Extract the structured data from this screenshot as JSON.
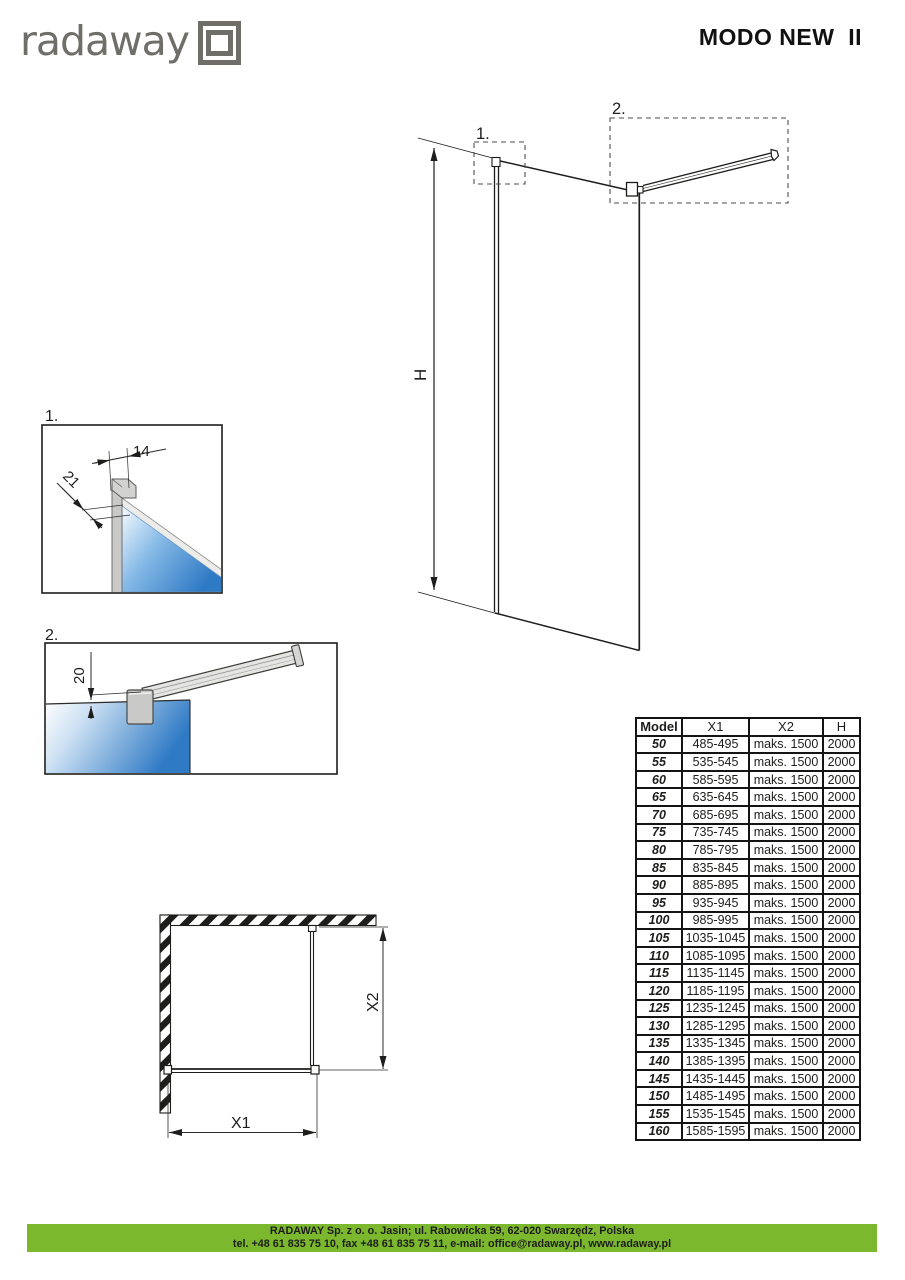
{
  "header": {
    "logo_text": "radaway",
    "title": "MODO NEW  II"
  },
  "drawing_labels": {
    "main_callout_1": "1.",
    "main_callout_2": "2.",
    "main_height": "H",
    "detail1_label": "1.",
    "detail1_width": "14",
    "detail1_depth": "21",
    "detail2_label": "2.",
    "detail2_gap": "20",
    "plan_x1": "X1",
    "plan_x2": "X2"
  },
  "table": {
    "headers": [
      "Model",
      "X1",
      "X2",
      "H"
    ],
    "rows": [
      {
        "model": "50",
        "x1": "485-495",
        "x2": "maks. 1500",
        "h": "2000"
      },
      {
        "model": "55",
        "x1": "535-545",
        "x2": "maks. 1500",
        "h": "2000"
      },
      {
        "model": "60",
        "x1": "585-595",
        "x2": "maks. 1500",
        "h": "2000"
      },
      {
        "model": "65",
        "x1": "635-645",
        "x2": "maks. 1500",
        "h": "2000"
      },
      {
        "model": "70",
        "x1": "685-695",
        "x2": "maks. 1500",
        "h": "2000"
      },
      {
        "model": "75",
        "x1": "735-745",
        "x2": "maks. 1500",
        "h": "2000"
      },
      {
        "model": "80",
        "x1": "785-795",
        "x2": "maks. 1500",
        "h": "2000"
      },
      {
        "model": "85",
        "x1": "835-845",
        "x2": "maks. 1500",
        "h": "2000"
      },
      {
        "model": "90",
        "x1": "885-895",
        "x2": "maks. 1500",
        "h": "2000"
      },
      {
        "model": "95",
        "x1": "935-945",
        "x2": "maks. 1500",
        "h": "2000"
      },
      {
        "model": "100",
        "x1": "985-995",
        "x2": "maks. 1500",
        "h": "2000"
      },
      {
        "model": "105",
        "x1": "1035-1045",
        "x2": "maks. 1500",
        "h": "2000"
      },
      {
        "model": "110",
        "x1": "1085-1095",
        "x2": "maks. 1500",
        "h": "2000"
      },
      {
        "model": "115",
        "x1": "1135-1145",
        "x2": "maks. 1500",
        "h": "2000"
      },
      {
        "model": "120",
        "x1": "1185-1195",
        "x2": "maks. 1500",
        "h": "2000"
      },
      {
        "model": "125",
        "x1": "1235-1245",
        "x2": "maks. 1500",
        "h": "2000"
      },
      {
        "model": "130",
        "x1": "1285-1295",
        "x2": "maks. 1500",
        "h": "2000"
      },
      {
        "model": "135",
        "x1": "1335-1345",
        "x2": "maks. 1500",
        "h": "2000"
      },
      {
        "model": "140",
        "x1": "1385-1395",
        "x2": "maks. 1500",
        "h": "2000"
      },
      {
        "model": "145",
        "x1": "1435-1445",
        "x2": "maks. 1500",
        "h": "2000"
      },
      {
        "model": "150",
        "x1": "1485-1495",
        "x2": "maks. 1500",
        "h": "2000"
      },
      {
        "model": "155",
        "x1": "1535-1545",
        "x2": "maks. 1500",
        "h": "2000"
      },
      {
        "model": "160",
        "x1": "1585-1595",
        "x2": "maks. 1500",
        "h": "2000"
      }
    ]
  },
  "footer": {
    "line1": "RADAWAY Sp. z o. o. Jasin; ul. Rabowicka 59, 62-020 Swarzędz, Polska",
    "line2": "tel. +48 61 835 75 10, fax +48 61 835 75 11, e-mail: office@radaway.pl, www.radaway.pl",
    "bar_color": "#7cb82e"
  },
  "colors": {
    "accent_green": "#7cb82e",
    "glass_blue": "#2f7ac5",
    "logo_gray": "#706e68",
    "line_black": "#1d1d1b"
  }
}
